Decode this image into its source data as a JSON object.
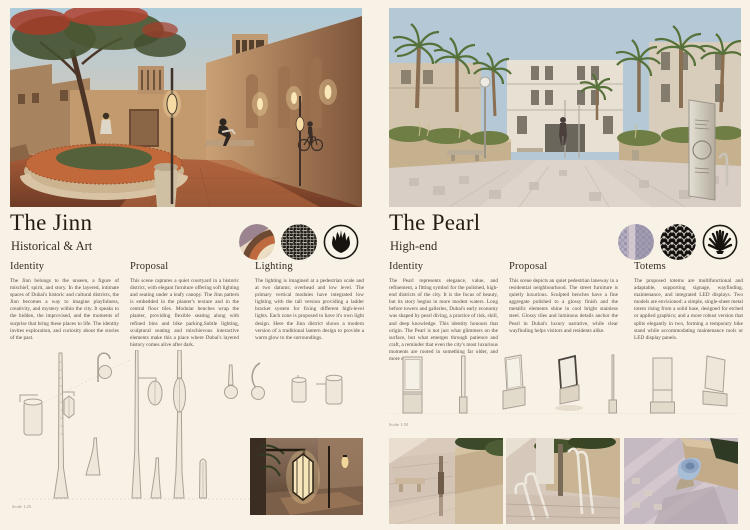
{
  "board": {
    "palette": {
      "cream_background": "#f8f1e6",
      "ink": "#2b241c",
      "terracotta": "#b06845",
      "sand": "#c49b72",
      "night_brown": "#4a392c",
      "lilac": "#b3aec2",
      "pattern_black": "#16130f"
    }
  },
  "jinn": {
    "title": "The Jinn",
    "subtitle": "Historical & Art",
    "swatch_icons": [
      "terracotta-material-photo",
      "hexagonal-net-pattern",
      "flame-emblem"
    ],
    "columns": [
      {
        "heading": "Identity",
        "body": "The Jinn belongs to the unseen, a figure of mischief, spirit, and story. In the layered, intimate spaces of Dubai's historic and cultural districts, the Jinn becomes a way to imagine playfulness, creativity, and mystery within the city. It speaks to the hidden, the improvised, and the moments of surprise that bring these places to life. The identity invites exploration, and curiosity about the stories of the past."
      },
      {
        "heading": "Proposal",
        "body": "This scene captures a quiet courtyard in a historic district, with elegant furniture offering soft lighting and seating under a leafy canopy. The Jinn pattern is embedded in the planter's texture and in the central floor tiles. Modular benches wrap the planter, providing flexible seating along with refined bins and bike parking.Subtle lighting, sculptural seating and mischievous interactive elements make this a place where Dubai's layered history comes alive after dark."
      },
      {
        "heading": "Lighting",
        "body": "The lighting is imagined at a pedestrian scale and at two datums; overhead and low level. The primary vertical modules have integrated low lighting with the tall version providing a ladder bracket system for fixing different high-level lights. Each zone is proposed to have it's own light design. Here the Jinn district shows a modern version of a traditional lantern design to provide a warm glow to the surroundings."
      }
    ],
    "scale_label": "Scale 1:25"
  },
  "pearl": {
    "title": "The Pearl",
    "subtitle": "High-end",
    "swatch_icons": [
      "lilac-mosaic-material-photo",
      "fish-scale-pattern",
      "shell-emblem"
    ],
    "columns": [
      {
        "heading": "Identity",
        "body": "The Pearl represents elegance, value, and refinement, a fitting symbol for the polished, high-end districts of the city. It is the focus of beauty, but its story begins in more modest waters. Long before towers and galleries, Dubai's early economy was shaped by pearl diving, a practice of risk, skill, and deep knowledge. This identity honours that origin. The Pearl is not just what glimmers on the surface, but what emerges through patience and craft, a reminder that even the city's most luxurious moments are rooted in something far older, and more elemental."
      },
      {
        "heading": "Proposal",
        "body": "This scene depicts an quiet pedestrian laneway in a residential neighbourhood. The street furniture is quietly luxurious. Sculpted benches have a fine aggregate polished to a glossy finish and the metallic elements shine in cool bright stainless steel. Glossy tiles and luminous details anchor the Pearl in Dubai's luxury narrative, while clear wayfinding helps visitors and residents alike."
      },
      {
        "heading": "Totems",
        "body": "The proposed totems are multifunctional and adaptable, supporting signage, wayfinding, maintenance, and integrated LED displays. Two models are envisioned: a simple, single-sheet metal totem rising from a solid base, designed for etched or applied graphics; and a more robust version that splits elegantly in two, forming a temporary bike stand while accommodating maintenance tools or LED display panels."
      }
    ],
    "scale_label": "Scale 1:50"
  }
}
